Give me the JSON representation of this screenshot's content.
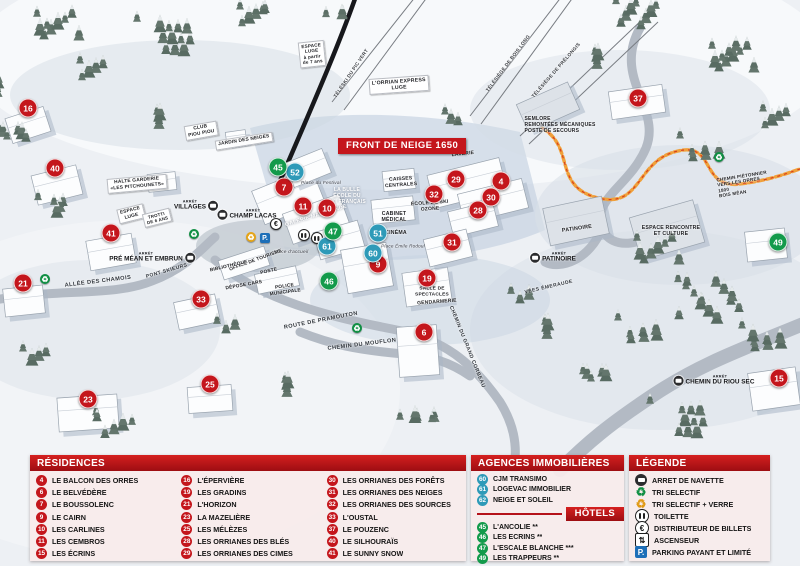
{
  "map": {
    "banner": "FRONT DE NEIGE 1650",
    "bus_stop_prefix": "ARRÊT",
    "markers": [
      {
        "id": "16",
        "color": "red",
        "x": 28,
        "y": 108
      },
      {
        "id": "40",
        "color": "red",
        "x": 55,
        "y": 168
      },
      {
        "id": "41",
        "color": "red",
        "x": 111,
        "y": 233
      },
      {
        "id": "21",
        "color": "red",
        "x": 23,
        "y": 283
      },
      {
        "id": "23",
        "color": "red",
        "x": 88,
        "y": 399
      },
      {
        "id": "25",
        "color": "red",
        "x": 210,
        "y": 384
      },
      {
        "id": "33",
        "color": "red",
        "x": 201,
        "y": 299
      },
      {
        "id": "7",
        "color": "red",
        "x": 284,
        "y": 187
      },
      {
        "id": "11",
        "color": "red",
        "x": 303,
        "y": 206
      },
      {
        "id": "10",
        "color": "red",
        "x": 327,
        "y": 208
      },
      {
        "id": "9",
        "color": "red",
        "x": 378,
        "y": 264
      },
      {
        "id": "19",
        "color": "red",
        "x": 427,
        "y": 278
      },
      {
        "id": "6",
        "color": "red",
        "x": 424,
        "y": 332
      },
      {
        "id": "29",
        "color": "red",
        "x": 456,
        "y": 179
      },
      {
        "id": "32",
        "color": "red",
        "x": 434,
        "y": 194
      },
      {
        "id": "4",
        "color": "red",
        "x": 501,
        "y": 181
      },
      {
        "id": "30",
        "color": "red",
        "x": 491,
        "y": 197
      },
      {
        "id": "28",
        "color": "red",
        "x": 478,
        "y": 210
      },
      {
        "id": "31",
        "color": "red",
        "x": 452,
        "y": 242
      },
      {
        "id": "37",
        "color": "red",
        "x": 638,
        "y": 98
      },
      {
        "id": "15",
        "color": "red",
        "x": 779,
        "y": 378
      },
      {
        "id": "52",
        "color": "blue",
        "x": 295,
        "y": 172
      },
      {
        "id": "61",
        "color": "blue",
        "x": 327,
        "y": 246
      },
      {
        "id": "51",
        "color": "blue",
        "x": 378,
        "y": 233
      },
      {
        "id": "60",
        "color": "blue",
        "x": 373,
        "y": 253
      },
      {
        "id": "45",
        "color": "green",
        "x": 278,
        "y": 167
      },
      {
        "id": "47",
        "color": "green",
        "x": 333,
        "y": 231
      },
      {
        "id": "46",
        "color": "green",
        "x": 329,
        "y": 281
      },
      {
        "id": "49",
        "color": "green",
        "x": 778,
        "y": 242
      }
    ],
    "labels": [
      {
        "text": "ESPACE\nLUGE\nà partir\nde 7 ans",
        "x": 312,
        "y": 54,
        "rot": -6,
        "cls": "sign",
        "size": 4.6
      },
      {
        "text": "L'ORRIAN EXPRESS\nLUGE",
        "x": 399,
        "y": 85,
        "rot": -4,
        "cls": "sign",
        "size": 5.2
      },
      {
        "text": "SEMLORE\nREMONTÉES MÉCANIQUES\nPOSTE DE SECOURS",
        "x": 560,
        "y": 126,
        "rot": 0,
        "cls": "place",
        "size": 5,
        "align": "left"
      },
      {
        "text": "CLUB\nPIOU PIOU",
        "x": 201,
        "y": 131,
        "rot": -10,
        "cls": "sign",
        "size": 4.8
      },
      {
        "text": "JARDIN DES NEIGES",
        "x": 244,
        "y": 141,
        "rot": -9,
        "cls": "sign",
        "size": 4.8
      },
      {
        "text": "HALTE GARDERIE\n«LES PITCHOUNETS»",
        "x": 137,
        "y": 184,
        "rot": -5,
        "cls": "sign",
        "size": 4.8
      },
      {
        "text": "ESPACE\nLUGE",
        "x": 131,
        "y": 214,
        "rot": -14,
        "cls": "sign",
        "size": 4.8
      },
      {
        "text": "TROTTI\nDE 6 ANS",
        "x": 157,
        "y": 218,
        "rot": -14,
        "cls": "sign",
        "size": 4.4
      },
      {
        "text": "Place du Festival",
        "x": 321,
        "y": 184,
        "rot": 0,
        "cls": "italic",
        "size": 4.8
      },
      {
        "text": "LA BULLE\nÉCOLE DU\nSKI FRANÇAIS",
        "x": 347,
        "y": 197,
        "rot": 0,
        "cls": "white",
        "size": 5
      },
      {
        "text": "CAISSES\nCENTRALES",
        "x": 401,
        "y": 183,
        "rot": -4,
        "cls": "place",
        "size": 5
      },
      {
        "text": "GALERIE MARCHANDE",
        "x": 316,
        "y": 216,
        "rot": -17,
        "cls": "white",
        "size": 5.4
      },
      {
        "text": "ÉCOLE DE SKI\nOZONE",
        "x": 430,
        "y": 207,
        "rot": -4,
        "cls": "place",
        "size": 5
      },
      {
        "text": "LAVERIE",
        "x": 463,
        "y": 155,
        "rot": -6,
        "cls": "place",
        "size": 5
      },
      {
        "text": "CABINET\nMÉDICAL",
        "x": 394,
        "y": 217,
        "rot": 0,
        "cls": "place",
        "size": 5.2
      },
      {
        "text": "CINÉMA",
        "x": 396,
        "y": 233,
        "rot": 0,
        "cls": "place",
        "size": 5.2
      },
      {
        "text": "Place Émile Rodoul",
        "x": 403,
        "y": 246,
        "rot": 0,
        "cls": "italic",
        "size": 4.6
      },
      {
        "text": "Place d'accueil",
        "x": 291,
        "y": 253,
        "rot": 0,
        "cls": "italic",
        "size": 4.8
      },
      {
        "text": "OFFICE DE TOURISME",
        "x": 256,
        "y": 261,
        "rot": -20,
        "cls": "place",
        "size": 4.8
      },
      {
        "text": "BIBLIOTHÈQUE",
        "x": 229,
        "y": 267,
        "rot": -13,
        "cls": "place",
        "size": 4.8
      },
      {
        "text": "POSTE",
        "x": 269,
        "y": 272,
        "rot": -13,
        "cls": "place",
        "size": 4.8
      },
      {
        "text": "DÉPOSE CARS",
        "x": 244,
        "y": 286,
        "rot": -10,
        "cls": "place",
        "size": 4.8
      },
      {
        "text": "POLICE\nMUNICIPALE",
        "x": 285,
        "y": 290,
        "rot": -8,
        "cls": "place",
        "size": 4.8
      },
      {
        "text": "SALLE DE\nSPECTACLES",
        "x": 432,
        "y": 292,
        "rot": 0,
        "cls": "place",
        "size": 4.8
      },
      {
        "text": "GENDARMERIE",
        "x": 437,
        "y": 303,
        "rot": -4,
        "cls": "place",
        "size": 5
      },
      {
        "text": "PATINOIRE",
        "x": 577,
        "y": 229,
        "rot": -8,
        "cls": "place",
        "size": 5.4
      },
      {
        "text": "ESPACE RENCONTRE\nET CULTURE",
        "x": 671,
        "y": 231,
        "rot": 0,
        "cls": "place",
        "size": 5.2
      },
      {
        "text": "CHEMIN PIÉTONNIER\nVERS LES ORRES 1800\nBOIS MÉAN",
        "x": 745,
        "y": 184,
        "rot": -9,
        "cls": "place",
        "size": 4.6,
        "align": "left"
      },
      {
        "text": "ALLÉE DES CHAMOIS",
        "x": 98,
        "y": 282,
        "rot": -7,
        "cls": "road",
        "size": 5.6
      },
      {
        "text": "PONT SKIEURS",
        "x": 167,
        "y": 272,
        "rot": -16,
        "cls": "road",
        "size": 5
      },
      {
        "text": "ROUTE DE PRAMOUTON",
        "x": 321,
        "y": 321,
        "rot": -11,
        "cls": "road",
        "size": 5.6
      },
      {
        "text": "CHEMIN DU MOUFLON",
        "x": 362,
        "y": 345,
        "rot": -7,
        "cls": "road",
        "size": 5.6
      },
      {
        "text": "CHEMIN DU GRAND CORBEAU",
        "x": 467,
        "y": 347,
        "rot": 68,
        "cls": "road",
        "size": 5.2
      },
      {
        "text": "VÉES ÉMERAUDE",
        "x": 549,
        "y": 288,
        "rot": -13,
        "cls": "road",
        "size": 5
      },
      {
        "text": "TÉLÉSKI DU PIC VERT",
        "x": 352,
        "y": 74,
        "rot": -56,
        "cls": "lift",
        "size": 4.8
      },
      {
        "text": "TÉLÉSIÈGE DE BOIS LONG",
        "x": 509,
        "y": 64,
        "rot": -53,
        "cls": "lift",
        "size": 4.8
      },
      {
        "text": "TÉLÉSIÈGE DE PRÉLONGIS",
        "x": 557,
        "y": 71,
        "rot": -49,
        "cls": "lift",
        "size": 4.8
      }
    ],
    "bus_stops": [
      {
        "name": "VILLAGES",
        "x": 196,
        "y": 206,
        "side": "right"
      },
      {
        "name": "CHAMP LACAS",
        "x": 247,
        "y": 215,
        "side": "left"
      },
      {
        "name": "PRÉ MÉAN ET EMBRUN",
        "x": 152,
        "y": 258,
        "side": "right"
      },
      {
        "name": "PATINOIRE",
        "x": 553,
        "y": 258,
        "side": "left"
      },
      {
        "name": "CHEMIN DU RIOU SEC",
        "x": 714,
        "y": 381,
        "side": "left"
      }
    ],
    "service_icons": [
      {
        "icon": "recycle-green",
        "x": 194,
        "y": 234
      },
      {
        "icon": "recycle-green",
        "x": 45,
        "y": 279
      },
      {
        "icon": "recycle-green",
        "x": 357,
        "y": 328
      },
      {
        "icon": "recycle-green",
        "x": 719,
        "y": 157
      },
      {
        "icon": "recycle-yellow",
        "x": 251,
        "y": 237
      },
      {
        "icon": "parking",
        "x": 265,
        "y": 238
      },
      {
        "icon": "euro",
        "x": 276,
        "y": 224
      },
      {
        "icon": "toilet",
        "x": 304,
        "y": 235
      },
      {
        "icon": "toilet",
        "x": 317,
        "y": 238
      }
    ]
  },
  "legend": {
    "residences": {
      "title": "RÉSIDENCES",
      "columns": [
        [
          {
            "num": "4",
            "label": "LE BALCON DES ORRES"
          },
          {
            "num": "6",
            "label": "LE BELVÉDÈRE"
          },
          {
            "num": "7",
            "label": "LE BOUSSOLENC"
          },
          {
            "num": "9",
            "label": "LE CAIRN"
          },
          {
            "num": "10",
            "label": "LES CARLINES"
          },
          {
            "num": "11",
            "label": "LES CEMBROS"
          },
          {
            "num": "15",
            "label": "LES ÉCRINS"
          }
        ],
        [
          {
            "num": "16",
            "label": "L'ÉPERVIÈRE"
          },
          {
            "num": "19",
            "label": "LES GRADINS"
          },
          {
            "num": "21",
            "label": "L'HORIZON"
          },
          {
            "num": "23",
            "label": "LA MAZELIÈRE"
          },
          {
            "num": "25",
            "label": "LES MÉLÈZES"
          },
          {
            "num": "28",
            "label": "LES ORRIANES DES BLÉS"
          },
          {
            "num": "29",
            "label": "LES ORRIANES DES CIMES"
          }
        ],
        [
          {
            "num": "30",
            "label": "LES ORRIANES DES FORÊTS"
          },
          {
            "num": "31",
            "label": "LES ORRIANES DES NEIGES"
          },
          {
            "num": "32",
            "label": "LES ORRIANES DES SOURCES"
          },
          {
            "num": "33",
            "label": "L'OUSTAL"
          },
          {
            "num": "37",
            "label": "LE POUZENC"
          },
          {
            "num": "40",
            "label": "LE SILHOURAÏS"
          },
          {
            "num": "41",
            "label": "LE SUNNY SNOW"
          }
        ]
      ]
    },
    "agences": {
      "title": "AGENCES IMMOBILIÈRES",
      "items": [
        {
          "num": "60",
          "label": "CJM TRANSIMO"
        },
        {
          "num": "61",
          "label": "LOGEVAC IMMOBILIER"
        },
        {
          "num": "62",
          "label": "NEIGE ET SOLEIL"
        }
      ]
    },
    "hotels": {
      "title": "HÔTELS",
      "items": [
        {
          "num": "45",
          "label": "L'ANCOLIE **"
        },
        {
          "num": "46",
          "label": "LES ECRINS **"
        },
        {
          "num": "47",
          "label": "L'ESCALE BLANCHE ***"
        },
        {
          "num": "49",
          "label": "LES TRAPPEURS **"
        }
      ]
    },
    "legende": {
      "title": "LÉGENDE",
      "items": [
        {
          "icon": "bus",
          "label": "ARRET DE NAVETTE"
        },
        {
          "icon": "recycle-green",
          "label": "TRI SELECTIF"
        },
        {
          "icon": "recycle-yellow",
          "label": "TRI SELECTIF + VERRE"
        },
        {
          "icon": "toilet",
          "label": "TOILETTE"
        },
        {
          "icon": "euro",
          "label": "DISTRIBUTEUR DE BILLETS"
        },
        {
          "icon": "elevator",
          "label": "ASCENSEUR"
        },
        {
          "icon": "parking",
          "label": "PARKING PAYANT ET LIMITÉ"
        }
      ]
    }
  },
  "colors": {
    "residence_red": "#c4161c",
    "agence_blue": "#2e9ab8",
    "hotel_green": "#139a4b",
    "parking_blue": "#1d6fb8",
    "path_orange": "#f0a03a"
  }
}
